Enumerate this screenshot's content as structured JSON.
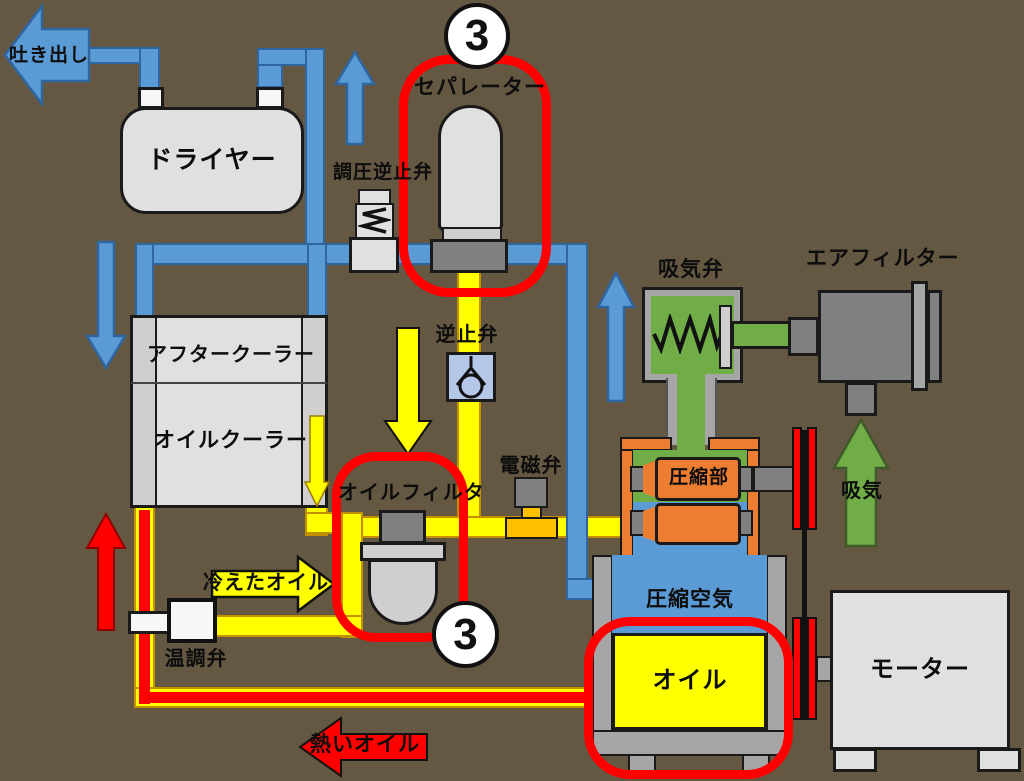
{
  "labels": {
    "discharge": "吐き出し",
    "dryer": "ドライヤー",
    "pressure_check_valve": "調圧逆止弁",
    "separator": "セパレーター",
    "check_valve": "逆止弁",
    "aftercooler": "アフタークーラー",
    "oil_cooler": "オイルクーラー",
    "oil_filter": "オイルフィルタ",
    "solenoid_valve": "電磁弁",
    "intake_valve": "吸気弁",
    "air_filter": "エアフィルター",
    "intake": "吸気",
    "compression_unit": "圧縮部",
    "compressed_air": "圧縮空気",
    "oil": "オイル",
    "motor": "モーター",
    "temp_control_valve": "温調弁",
    "cooled_oil": "冷えたオイル",
    "hot_oil": "熱いオイル"
  },
  "badges": {
    "separator_number": "3",
    "oil_filter_number": "3"
  },
  "colors": {
    "background": "#655843",
    "air_pipe_blue": "#5b9bd5",
    "oil_pipe_yellow": "#ffff00",
    "intake_green": "#70ad47",
    "hot_oil_red": "#ff0000",
    "compressor_orange": "#ed7d31",
    "solenoid_base_orange": "#ffc000",
    "check_valve_blue": "#b4c7e7",
    "component_light_gray": "#e0e0e0",
    "component_dark_gray": "#808080",
    "highlight_oval_red": "#ff0000"
  }
}
